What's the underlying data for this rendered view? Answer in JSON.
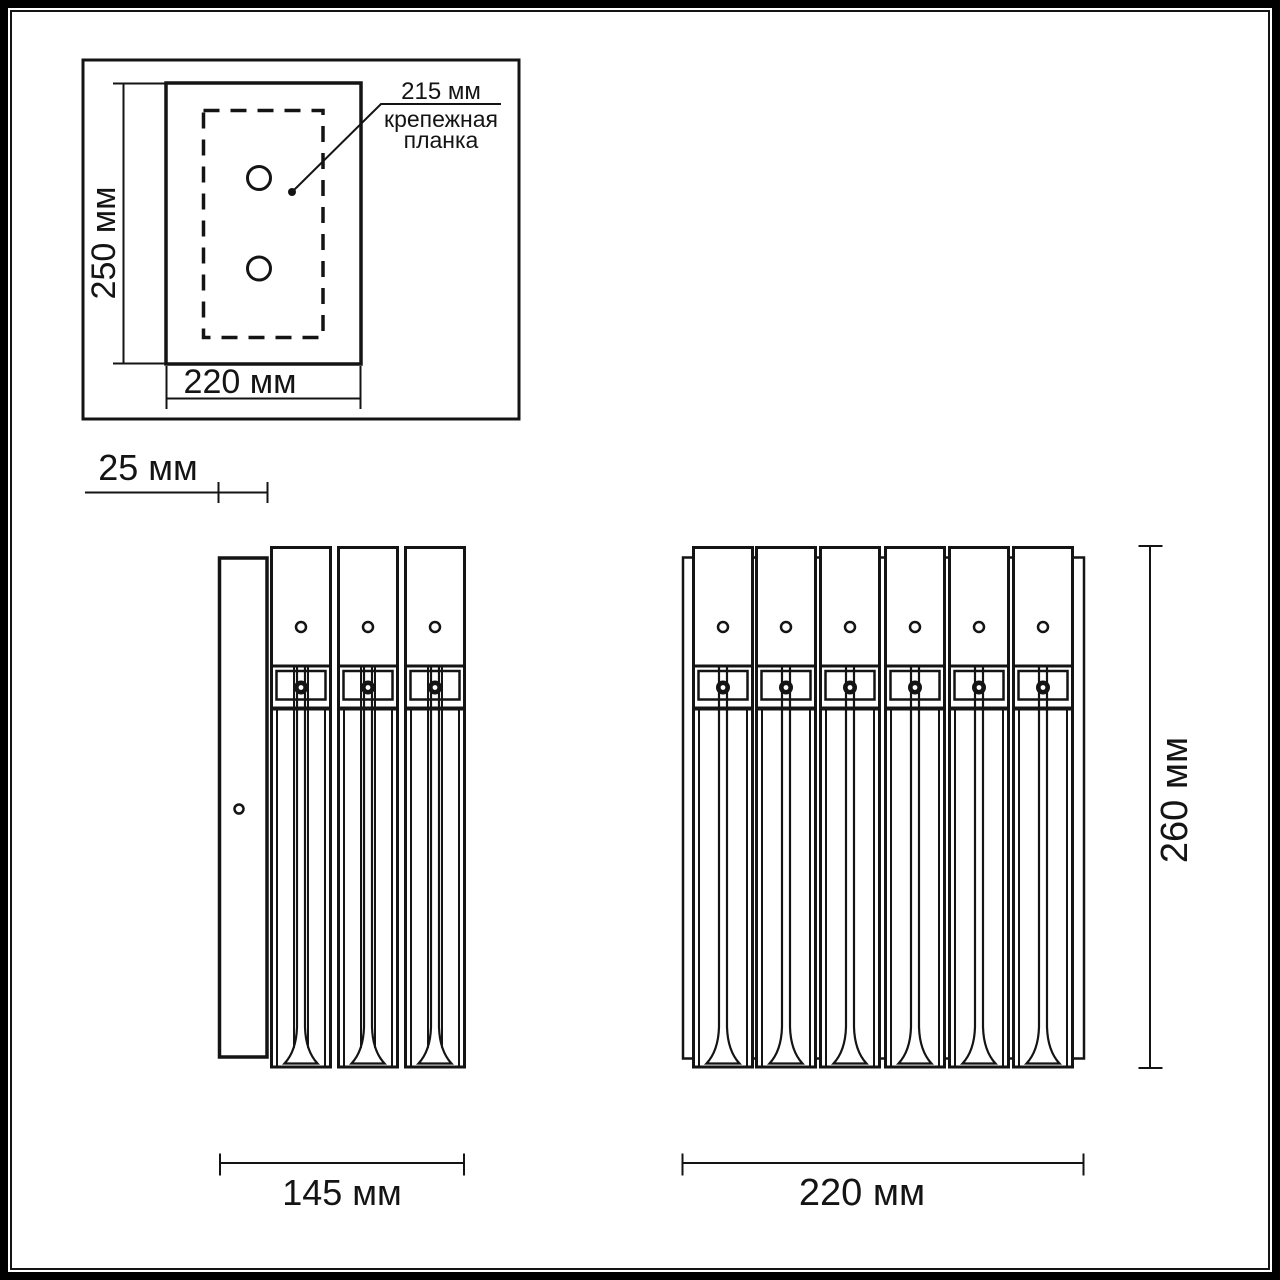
{
  "colors": {
    "line": "#141414",
    "background": "#ffffff"
  },
  "views": {
    "top": {
      "height_dim": "250 мм",
      "width_dim": "220 мм",
      "bracket": {
        "dim": "215 мм",
        "label_line1": "крепежная",
        "label_line2": "планка"
      }
    },
    "side": {
      "depth_dim": "25 мм",
      "width_dim": "145 мм"
    },
    "front": {
      "height_dim": "260 мм",
      "width_dim": "220 мм"
    }
  }
}
